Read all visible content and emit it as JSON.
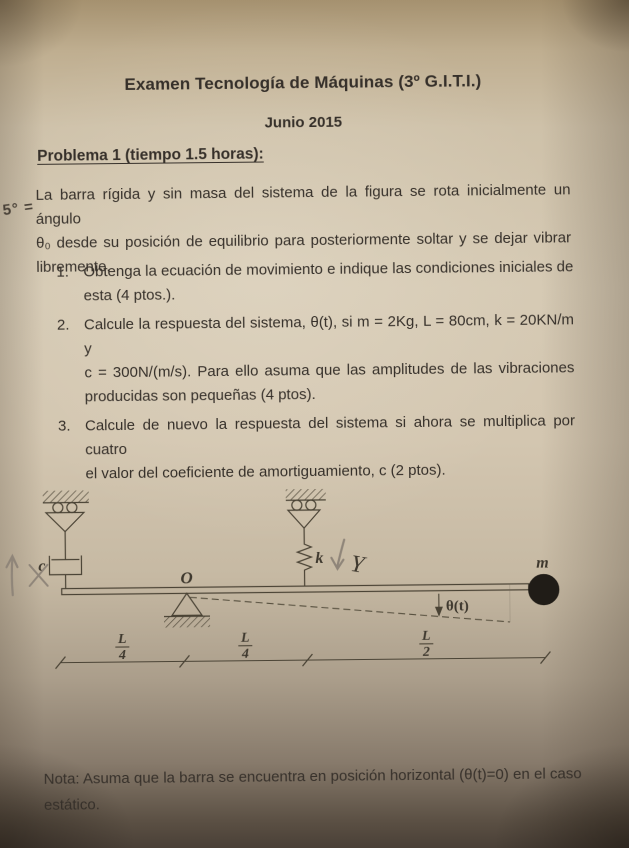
{
  "document": {
    "title": "Examen Tecnología de Máquinas (3º G.I.T.I.)",
    "date": "Junio 2015",
    "problem_heading": "Problema 1 (tiempo 1.5 horas):",
    "intro_lines": [
      "La barra rígida y sin masa del sistema de la figura se rota inicialmente un ángulo",
      "θ₀ desde su posición de equilibrio para posteriormente soltar y se dejar vibrar",
      "libremente."
    ],
    "items": [
      {
        "number": "1.",
        "lines": [
          "Obtenga la ecuación de movimiento e indique las condiciones iniciales de",
          "esta (4 ptos.)."
        ]
      },
      {
        "number": "2.",
        "lines": [
          "Calcule la respuesta del sistema, θ(t), si m = 2Kg, L = 80cm, k = 20KN/m y",
          "c = 300N/(m/s). Para ello asuma que las amplitudes de las vibraciones",
          "producidas son pequeñas (4 ptos)."
        ]
      },
      {
        "number": "3.",
        "lines": [
          "Calcule de nuevo la respuesta del sistema si ahora se multiplica por cuatro",
          "el valor del coeficiente de amortiguamiento, c (2 ptos)."
        ]
      }
    ],
    "note_lines": [
      "Nota: Asuma que la barra se encuentra en posición horizontal (θ(t)=0) en el caso",
      "estático."
    ]
  },
  "handwriting": {
    "pen_angle": "5° =",
    "pencil_y": "Y",
    "pencil_x": "×"
  },
  "diagram": {
    "damper_label": "c",
    "pivot_label": "O",
    "spring_label": "k",
    "mass_label": "m",
    "angle_label": "θ(t)",
    "dimensions": [
      {
        "num": "L",
        "den": "4"
      },
      {
        "num": "L",
        "den": "4"
      },
      {
        "num": "L",
        "den": "2"
      }
    ]
  },
  "colors": {
    "ink": "#36302a",
    "paper": "#d5c9b3",
    "line": "#4a4335",
    "pencil": "#8f8579",
    "mass_fill": "#201c17"
  }
}
